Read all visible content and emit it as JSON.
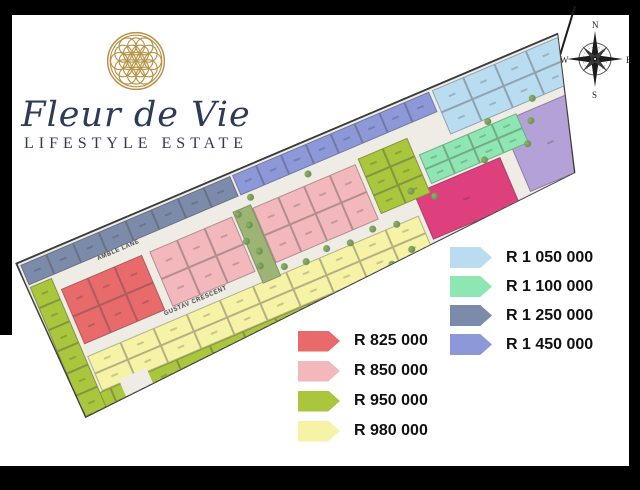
{
  "brand": {
    "name": "Fleur de Vie",
    "tagline": "LIFESTYLE ESTATE"
  },
  "compass": {
    "north": "N",
    "south": "S",
    "east": "E",
    "west": "W"
  },
  "map": {
    "streets": {
      "amble": "AMBLE LANE",
      "gustav": "GUSTAV CRESCENT",
      "public": "PUBLIC ROAD"
    },
    "zones": [
      {
        "id": "slate-top-row",
        "price": "R 1 250 000",
        "color": "#7d8bab",
        "cols": 8,
        "rows": 1
      },
      {
        "id": "periwinkle-top-row",
        "price": "R 1 450 000",
        "color": "#8c98d8",
        "cols": 8,
        "rows": 1
      },
      {
        "id": "lightblue-corner",
        "price": "R 1 050 000",
        "color": "#badcf1",
        "cols": 4,
        "rows": 2
      },
      {
        "id": "green-left-edge",
        "price": "R 950 000",
        "color": "#a9c63d",
        "cols": 1,
        "rows": 6
      },
      {
        "id": "red-block",
        "price": "R 825 000",
        "color": "#e86a6a",
        "cols": 3,
        "rows": 2
      },
      {
        "id": "pink-block-west",
        "price": "R 850 000",
        "color": "#f2b8bc",
        "cols": 3,
        "rows": 2
      },
      {
        "id": "pink-block-east",
        "price": "R 850 000",
        "color": "#f2b8bc",
        "cols": 4,
        "rows": 2
      },
      {
        "id": "olive-block",
        "price": "R 950 000",
        "color": "#a9c63d",
        "cols": 2,
        "rows": 3
      },
      {
        "id": "mint-block",
        "price": "R 1 100 000",
        "color": "#8ee7b2",
        "cols": 4,
        "rows": 2
      },
      {
        "id": "magenta-plot",
        "price": "",
        "color": "#de3f7d",
        "cols": 1,
        "rows": 1
      },
      {
        "id": "lavender-plot",
        "price": "",
        "color": "#b4a1d7",
        "cols": 1,
        "rows": 1
      },
      {
        "id": "yellow-band",
        "price": "R 980 000",
        "color": "#f6f3a6",
        "cols": 10,
        "rows": 2
      },
      {
        "id": "green-bottom-edge",
        "price": "R 950 000",
        "color": "#a9c63d",
        "cols": 12,
        "rows": 1
      }
    ]
  },
  "legend_left": [
    {
      "label": "R 825 000",
      "color": "#e86a6a"
    },
    {
      "label": "R 850 000",
      "color": "#f2b8bc"
    },
    {
      "label": "R 950 000",
      "color": "#a9c63d"
    },
    {
      "label": "R 980 000",
      "color": "#f6f3a6"
    }
  ],
  "legend_right": [
    {
      "label": "R 1 050 000",
      "color": "#badcf1"
    },
    {
      "label": "R 1 100 000",
      "color": "#8ee7b2"
    },
    {
      "label": "R 1 250 000",
      "color": "#7d8bab"
    },
    {
      "label": "R 1 450 000",
      "color": "#8c98d8"
    }
  ],
  "colors": {
    "brand_navy": "#2e3a5a",
    "logo_gold": "#b69244",
    "road": "#efece6",
    "magenta_feature_plot": "#de3f7d",
    "lavender_feature_plot": "#b4a1d7",
    "frame_black": "#000000"
  }
}
